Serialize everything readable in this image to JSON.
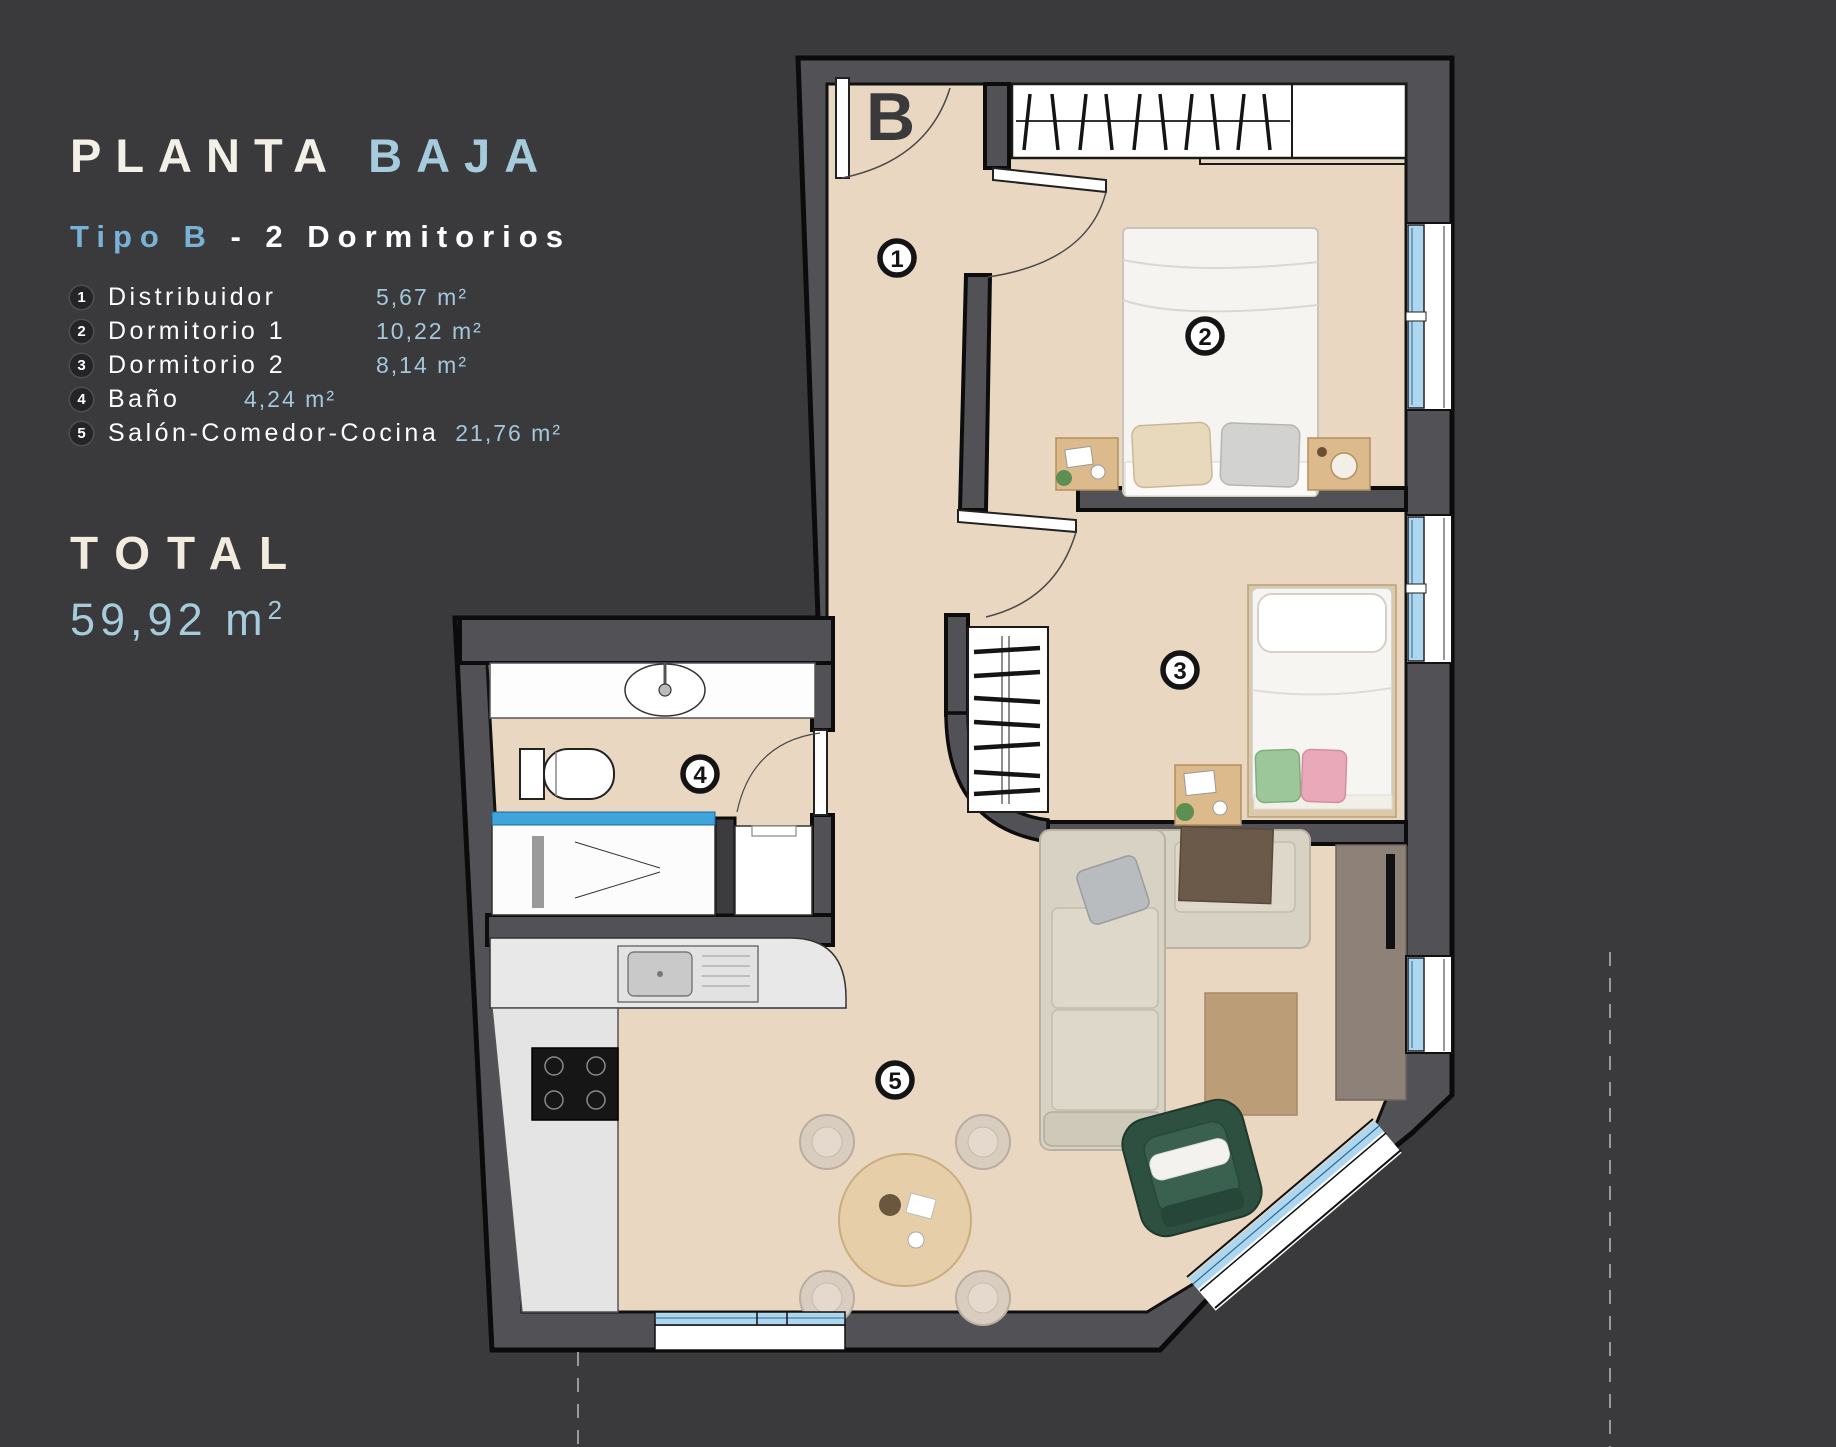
{
  "title": {
    "main": "PLANTA",
    "accent": "BAJA"
  },
  "subtitle": {
    "accent": "Tipo B",
    "rest": "- 2 Dormitorios"
  },
  "legend": [
    {
      "num": "1",
      "name": "Distribuidor",
      "area": "5,67 m²"
    },
    {
      "num": "2",
      "name": "Dormitorio 1",
      "area": "10,22 m²"
    },
    {
      "num": "3",
      "name": "Dormitorio 2",
      "area": "8,14 m²"
    },
    {
      "num": "4",
      "name": "Baño",
      "area": "4,24 m²"
    },
    {
      "num": "5",
      "name": "Salón-Comedor-Cocina",
      "area": "21,76 m²"
    }
  ],
  "total": {
    "label": "TOTAL",
    "value": "59,92 m",
    "sup": "2"
  },
  "plan": {
    "letter": "B",
    "badges": [
      "1",
      "2",
      "3",
      "4",
      "5"
    ]
  },
  "colors": {
    "background": "#3a393b",
    "wall": "#525155",
    "floor": "#e9d7c1",
    "accent_blue": "#a5cbdc",
    "subtitle_blue": "#79b2d6",
    "window_glass": "#aed7ef",
    "cream": "#f1ecdd"
  }
}
